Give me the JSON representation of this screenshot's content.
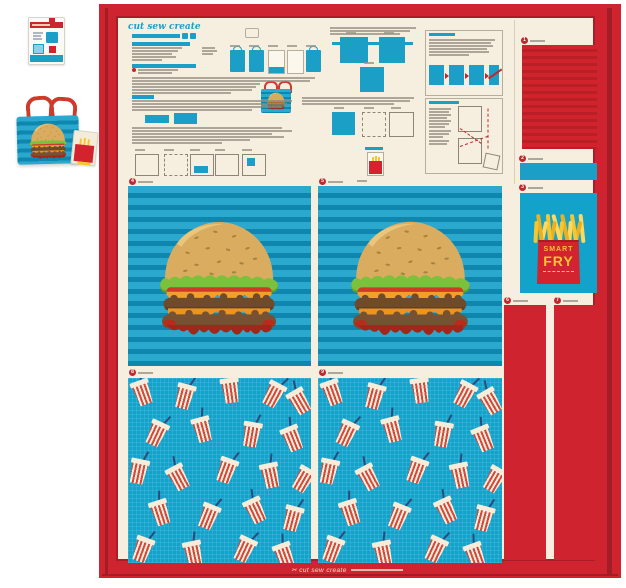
{
  "product": {
    "brand_logo": "cut sew create",
    "footer_brand": "✂ cut sew create",
    "fry_box": {
      "word_top": "SMART",
      "word_bottom": "FRY"
    },
    "panel_labels": [
      {
        "num": "1"
      },
      {
        "num": "2"
      },
      {
        "num": "3"
      },
      {
        "num": "4"
      },
      {
        "num": "5"
      },
      {
        "num": "6"
      },
      {
        "num": "7"
      },
      {
        "num": "8"
      },
      {
        "num": "9"
      }
    ]
  },
  "colors": {
    "frame_red": "#cf2430",
    "frame_red_dark": "#a31d26",
    "cream": "#f6efdf",
    "teal": "#1b9fc7",
    "stripe_teal_light": "#2aa8ce",
    "stripe_teal_dark": "#0e86ae",
    "cup_red": "#d2493d",
    "fry_yellow": "#f6c630",
    "label_red": "#c1272d"
  }
}
